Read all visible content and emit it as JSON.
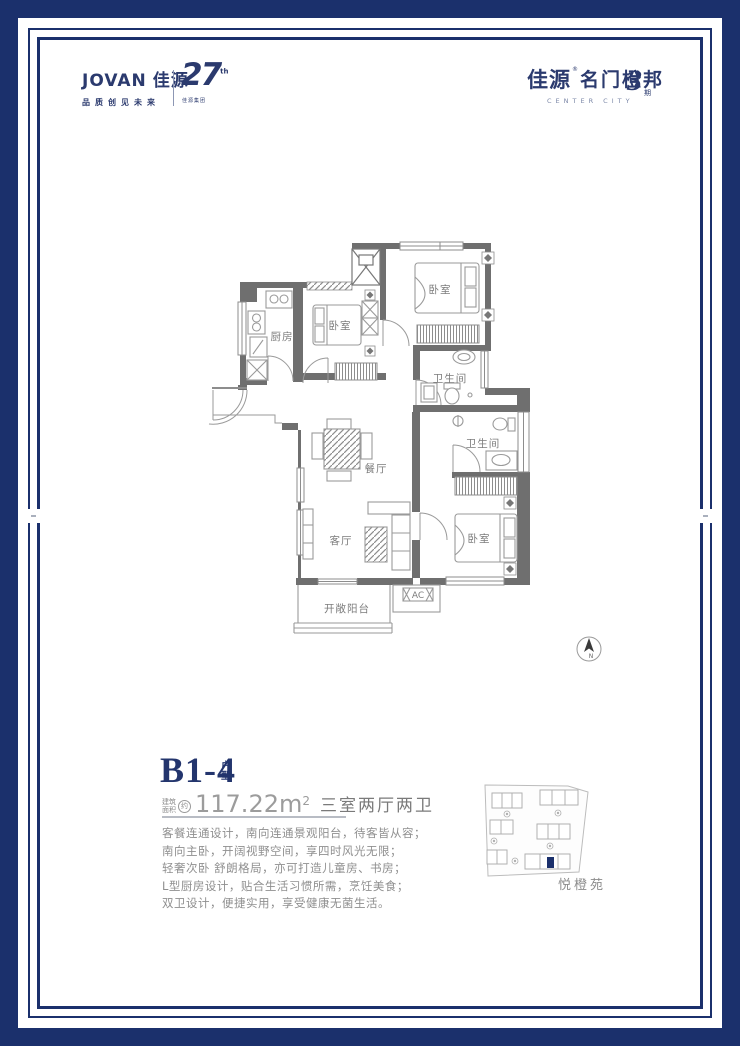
{
  "frame": {
    "color": "#1b306c"
  },
  "header": {
    "left_logo": {
      "brand_en": "JOVAN",
      "brand_cn": "佳源",
      "tagline": "品质创见未来",
      "badge_number": "27",
      "badge_sup": "th",
      "badge_sub": "佳源集团"
    },
    "right_logo": {
      "brand": "佳源",
      "reg_mark": "®",
      "name": "名门橙邦",
      "subtitle": "CENTER CITY",
      "phase_number": "3",
      "phase_unit": "期"
    }
  },
  "floorplan": {
    "rooms": {
      "bedroom_top": "卧室",
      "bedroom_mid": "卧室",
      "bedroom_bottom": "卧室",
      "kitchen": "厨房",
      "bathroom_top": "卫生间",
      "bathroom_mid": "卫生间",
      "dining": "餐厅",
      "living": "客厅",
      "balcony": "开敞阳台",
      "ac": "AC"
    },
    "compass": {
      "letter": "N"
    }
  },
  "unit": {
    "name": "B1-4",
    "name_suffix_1": "户",
    "name_suffix_2": "型",
    "area_label_1": "建筑",
    "area_label_2": "面积",
    "area_approx": "约",
    "area_value": "117.22",
    "area_unit": "m",
    "area_sup": "2",
    "layout_text": "三室两厅两卫",
    "description": [
      "客餐连通设计，南向连通景观阳台，待客皆从容；",
      "南向主卧，开阔视野空间，享四时风光无限；",
      "轻奢次卧 舒朗格局，亦可打造儿童房、书房；",
      "L型厨房设计，贴合生活习惯所需，烹饪美食；",
      "双卫设计，便捷实用，享受健康无菌生活。"
    ]
  },
  "sitemap": {
    "label": "悦橙苑"
  }
}
